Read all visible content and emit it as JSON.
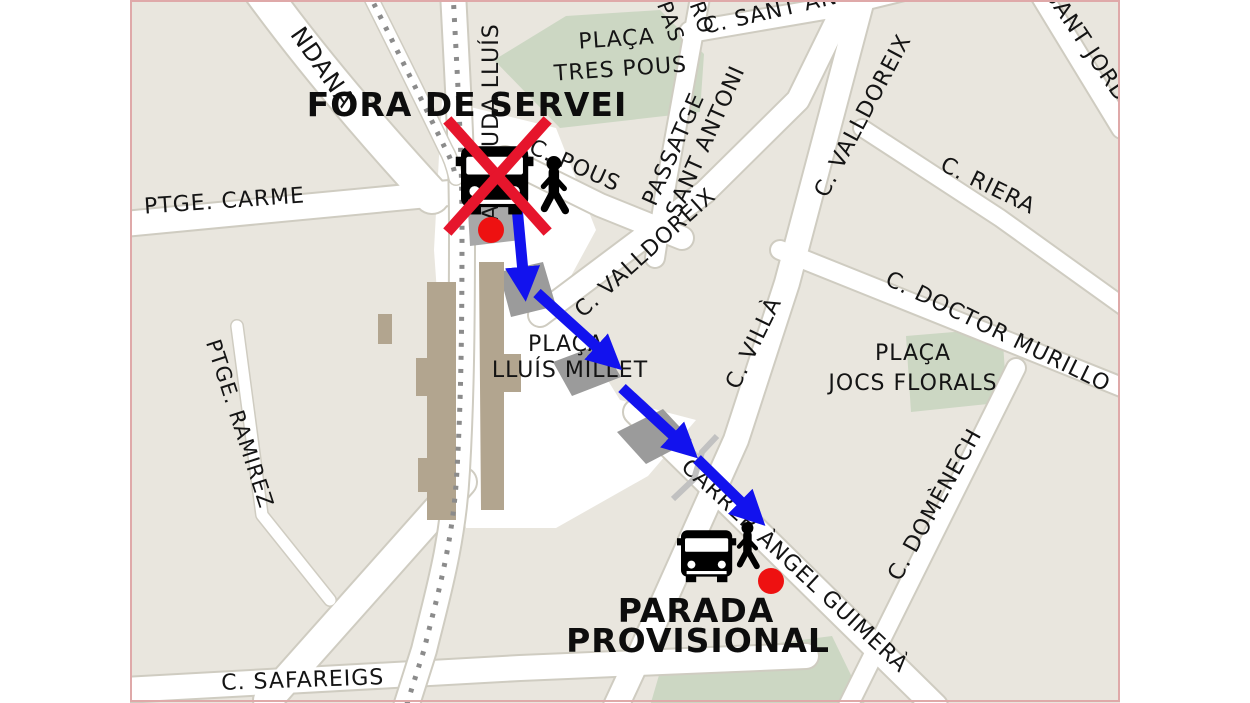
{
  "annotations": {
    "out_of_service": "FORA DE SERVEI",
    "provisional_line1": "PARADA",
    "provisional_line2": "PROVISIONAL"
  },
  "streets": {
    "andana": "NDANA",
    "ptge_carme": "PTGE. CARME",
    "avinguda_lluis": "AVINGUDA LLUÍS",
    "c_pous": "C. POUS",
    "passatge_line1": "PASSATGE",
    "passatge_line2": "SANT ANTONI",
    "pas_fragment": "PAS",
    "ro_fragment": "RO",
    "c_sant_antoni": "C. SANT ANTONI",
    "c_valldoreix": "C. VALLDOREIX",
    "sant_jordi": "SANT JORDI",
    "c_riera": "C. RIERA",
    "c_villa": "C. VILLÀ",
    "c_doctor_murillo": "C. DOCTOR MURILLO",
    "carrer_angel_guimera": "CARRER ÀNGEL GUIMERÀ",
    "c_domenech": "C. DOMÈNECH",
    "ptge_ramirez": "PTGE. RAMIREZ",
    "c_safareigs": "C. SAFAREIGS"
  },
  "places": {
    "tres_pous_line1": "PLAÇA",
    "tres_pous_line2": "TRES POUS",
    "lluis_millet_line1": "PLAÇA",
    "lluis_millet_line2": "LLUÍS MILLET",
    "jocs_florals_line1": "PLAÇA",
    "jocs_florals_line2": "JOCS FLORALS"
  },
  "colors": {
    "land": "#e9e6de",
    "road": "#ffffff",
    "road_casing": "#cfccc1",
    "green_area": "#ccd7c3",
    "station_building": "#b2a58f",
    "crossing_gray": "#9b9b9b",
    "railway_dash": "#8b8b8b",
    "route_arrow_blue": "#1212ee",
    "stop_marker_red": "#ee1111",
    "no_service_cross_red": "#e6152c",
    "label_text": "#141414",
    "map_border_pink": "#dfa9a9"
  }
}
